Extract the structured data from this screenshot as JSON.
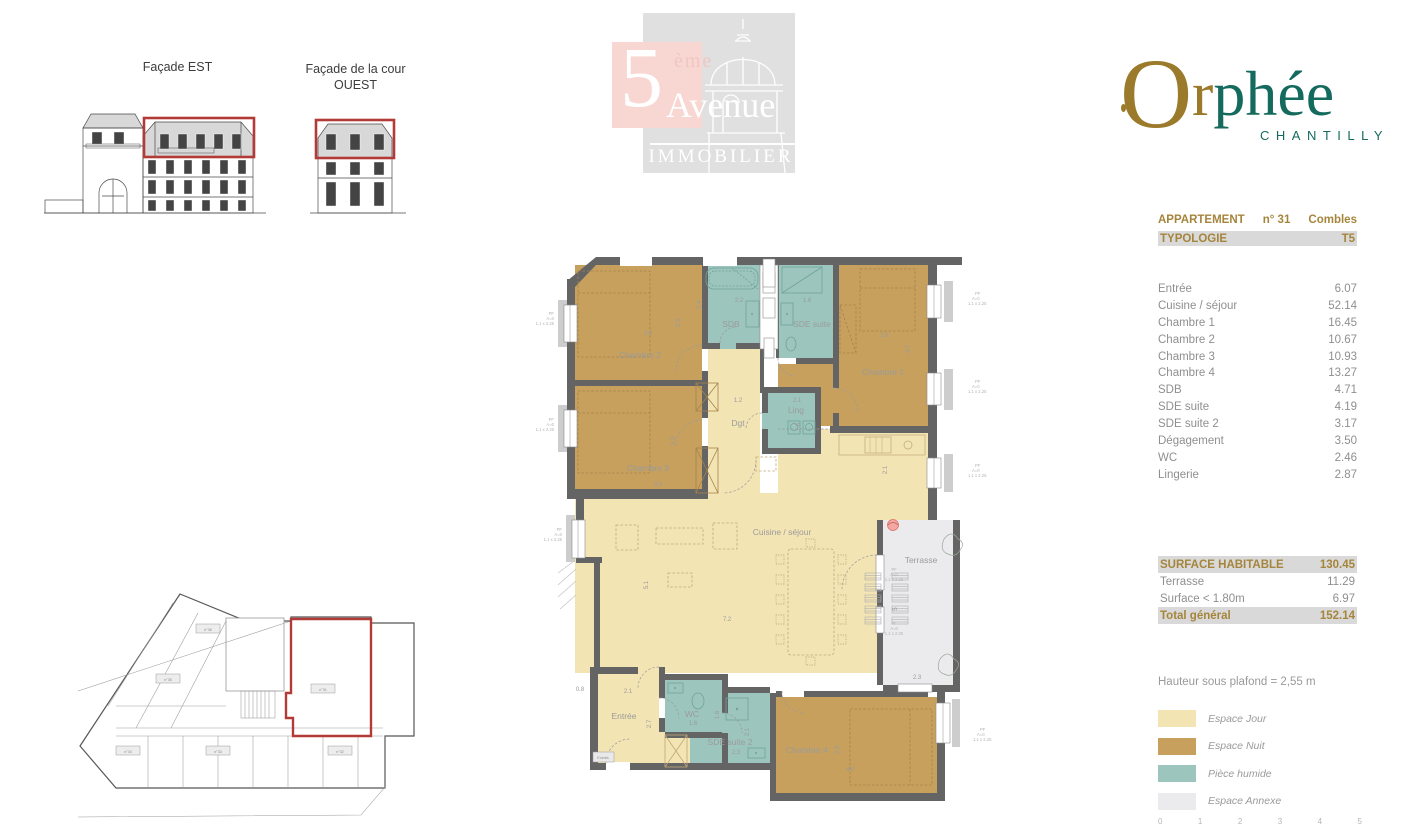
{
  "facades": {
    "east_label": "Façade EST",
    "west_label_1": "Façade de la cour",
    "west_label_2": "OUEST"
  },
  "agency_logo": {
    "five": "5",
    "eme": "ème",
    "avenue": "Avenue",
    "immobilier": "IMMOBILIER"
  },
  "brand": {
    "o": "O",
    "r_gold": "r",
    "phee_teal": "phée",
    "city": "CHANTILLY"
  },
  "apartment": {
    "header_label": "APPARTEMENT",
    "header_number": "n° 31",
    "header_level": "Combles",
    "typology_label": "TYPOLOGIE",
    "typology_value": "T5",
    "rooms": [
      {
        "name": "Entrée",
        "area": "6.07"
      },
      {
        "name": "Cuisine / séjour",
        "area": "52.14"
      },
      {
        "name": "Chambre 1",
        "area": "16.45"
      },
      {
        "name": "Chambre 2",
        "area": "10.67"
      },
      {
        "name": "Chambre 3",
        "area": "10.93"
      },
      {
        "name": "Chambre 4",
        "area": "13.27"
      },
      {
        "name": "SDB",
        "area": "4.71"
      },
      {
        "name": "SDE suite",
        "area": "4.19"
      },
      {
        "name": "SDE suite 2",
        "area": "3.17"
      },
      {
        "name": "Dégagement",
        "area": "3.50"
      },
      {
        "name": "WC",
        "area": "2.46"
      },
      {
        "name": "Lingerie",
        "area": "2.87"
      }
    ],
    "surfaces": [
      {
        "name": "SURFACE HABITABLE",
        "area": "130.45"
      },
      {
        "name": "Terrasse",
        "area": "11.29"
      },
      {
        "name": "Surface < 1.80m",
        "area": "6.97"
      },
      {
        "name": "Total général",
        "area": "152.14"
      }
    ],
    "ceiling_note": "Hauteur sous plafond =  2,55 m"
  },
  "legend": [
    {
      "label": "Espace Jour",
      "color": "#f3e4b4"
    },
    {
      "label": "Espace Nuit",
      "color": "#c7a05e"
    },
    {
      "label": "Pièce humide",
      "color": "#9cc5bd"
    },
    {
      "label": "Espace Annexe",
      "color": "#ebebed"
    }
  ],
  "plan": {
    "rooms": {
      "chambre2": "Chambre 2",
      "sdb": "SDB",
      "sde_suite": "SDE suite",
      "chambre1": "Chambre 1",
      "chambre3": "Chambre 3",
      "dgt": "Dgt",
      "ling": "Ling",
      "cuisine": "Cuisine / séjour",
      "terrasse": "Terrasse",
      "entree": "Entrée",
      "wc": "WC",
      "sde_suite2": "SDE suite 2",
      "chambre4": "Chambre 4"
    },
    "dims": {
      "ch2_w": "2.8",
      "ch2_h": "3.5",
      "sdb_w": "2.2",
      "sdb_h": "2.4",
      "sde_w": "1.6",
      "ch1_w": "2.8",
      "ch1_h": "4.7",
      "ch3_h": "3.3",
      "ch3_w": "3.3",
      "dgt_w": "1.2",
      "ling_w": "2.1",
      "ling_h": "1.6",
      "kitchen_w": "2.1",
      "cui_h": "5.1",
      "cui_w": "7.2",
      "ter_h": "5",
      "ter_w": "2.3",
      "ent_a": "0.8",
      "ent_w": "2.1",
      "ent_h": "2.7",
      "wc_w": "1.6",
      "wc_h": "1.6",
      "sde2_w": "2.3",
      "sde2_h": "2.1",
      "ch4_h": "2.9",
      "ch4_w": "4.8"
    },
    "pf": [
      "PF",
      "A=0",
      "1.1 x 2.25"
    ],
    "enedis": "Enedis"
  },
  "siteplan": {
    "u36": "n°36",
    "u35": "n°35",
    "u34": "n°34",
    "u33": "n°33",
    "u32": "n°32",
    "u31": "n°31"
  },
  "scalebar": [
    "0",
    "1",
    "2",
    "3",
    "4",
    "5"
  ],
  "colors": {
    "espace_jour": "#f3e4b4",
    "espace_nuit": "#c7a05e",
    "piece_humide": "#9cc5bd",
    "espace_annexe": "#ebebed",
    "wall": "#646464",
    "highlight_red": "#b23b38",
    "brand_gold": "#9b7b2b",
    "brand_teal": "#156a5e",
    "table_gold": "#a5853c",
    "bar_gray": "#d9d9d9"
  }
}
